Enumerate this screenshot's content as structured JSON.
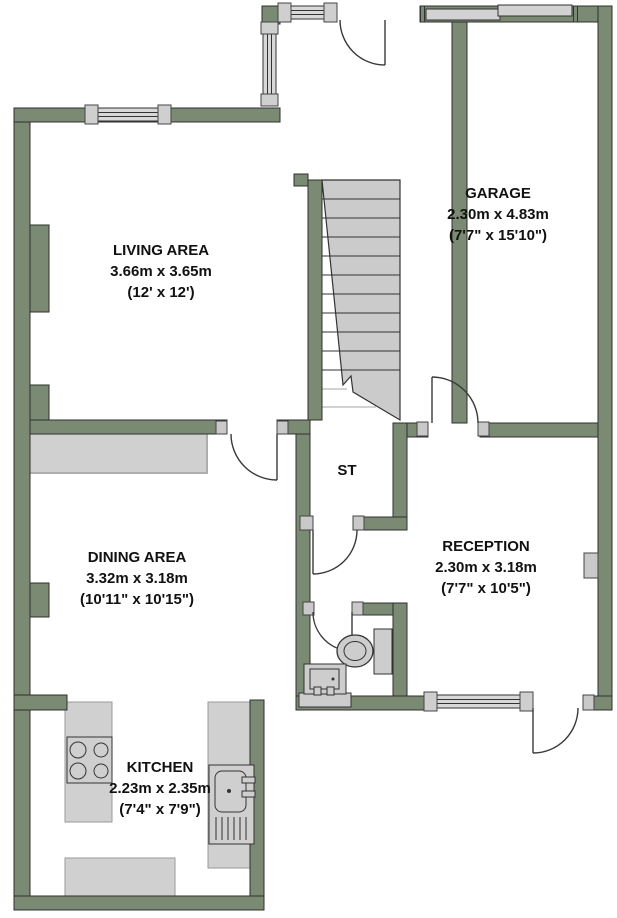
{
  "plan": {
    "type": "floor-plan",
    "wall_color": "#7b8a73",
    "fixture_gray": "#cfcfcf",
    "outline_color": "#333333",
    "rooms": [
      {
        "id": "living",
        "name": "LIVING AREA",
        "metric": "3.66m x 3.65m",
        "imperial": "(12' x 12')"
      },
      {
        "id": "garage",
        "name": "GARAGE",
        "metric": "2.30m x 4.83m",
        "imperial": "(7'7\" x 15'10\")"
      },
      {
        "id": "dining",
        "name": "DINING AREA",
        "metric": "3.32m x 3.18m",
        "imperial": "(10'11\" x 10'15\")"
      },
      {
        "id": "reception",
        "name": "RECEPTION",
        "metric": "2.30m x 3.18m",
        "imperial": "(7'7\" x 10'5\")"
      },
      {
        "id": "kitchen",
        "name": "KITCHEN",
        "metric": "2.23m x 2.35m",
        "imperial": "(7'4\" x 7'9\")"
      },
      {
        "id": "storage",
        "name": "ST"
      }
    ],
    "fixtures": [
      "staircase",
      "toilet",
      "wash-basin",
      "kitchen-sink",
      "hob",
      "counters",
      "garage-door",
      "windows",
      "radiator"
    ]
  }
}
